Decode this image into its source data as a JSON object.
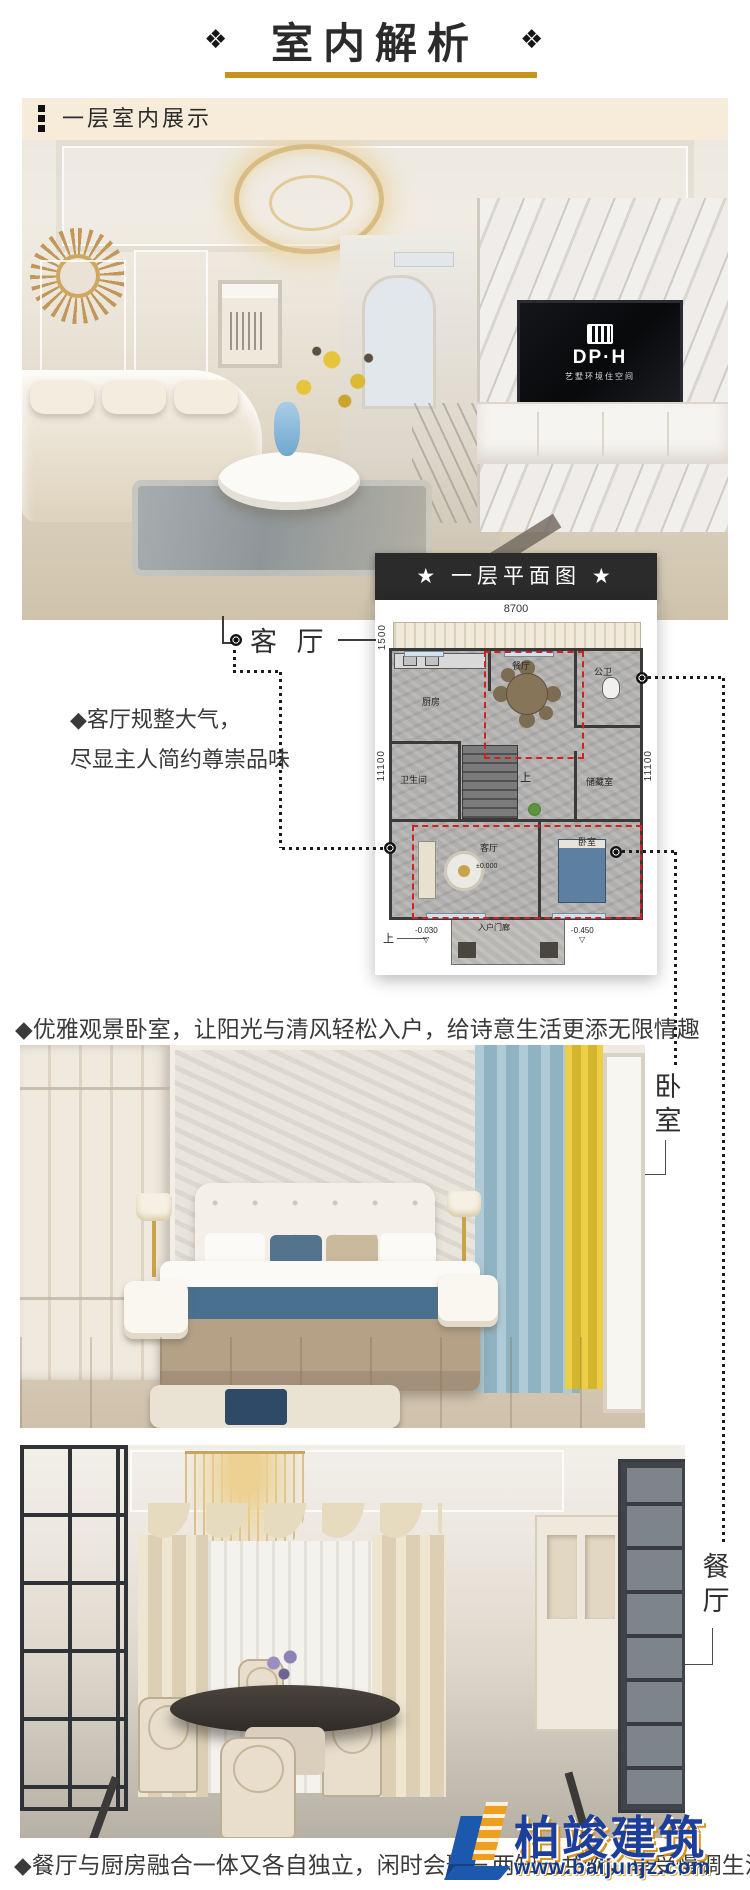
{
  "header": {
    "title": "室内解析",
    "ornament_left": "❖",
    "ornament_right": "❖"
  },
  "section": {
    "title": "一层室内展示"
  },
  "living": {
    "callout_label": "客 厅",
    "desc_line1": "◆客厅规整大气，",
    "desc_line2": "尽显主人简约尊崇品味",
    "tv_brand": "DP·H",
    "tv_tagline": "艺墅环境住空间"
  },
  "bedroom": {
    "desc": "◆优雅观景卧室，让阳光与清风轻松入户，给诗意生活更添无限情趣",
    "chars": [
      "卧",
      "室"
    ]
  },
  "dining": {
    "desc": "◆餐厅与厨房融合一体又各自独立，闲时会聚三两知己共饮，享受慢调生活",
    "chars": [
      "餐",
      "厅"
    ]
  },
  "plan": {
    "title": "★ 一层平面图 ★",
    "dims": {
      "top": "8700",
      "terrace": "1500",
      "left": "11100",
      "right": "11100"
    },
    "rooms": {
      "kitchen": "厨房",
      "dining": "餐厅",
      "public_wc": "公卫",
      "bathroom": "卫生间",
      "storage": "储藏室",
      "living": "客厅",
      "bedroom": "卧室"
    },
    "porch": "入户门廊",
    "stairs_up": "上",
    "stairs_up_outside": "上",
    "elevations": {
      "living": "±0.000",
      "porch": "-0.030",
      "outdoor": "-0.450",
      "marker": "▽"
    }
  },
  "watermark": {
    "name": "柏竣建筑",
    "url": "www.baijunjz.com"
  },
  "colors": {
    "accent_gold": "#c8921e",
    "band_bg": "#f6ecd9",
    "plan_bar": "#2b2b2b",
    "red_dash": "#d02020",
    "wm_blue": "#1d3e9a",
    "wm_gold": "#ef9f1f"
  }
}
